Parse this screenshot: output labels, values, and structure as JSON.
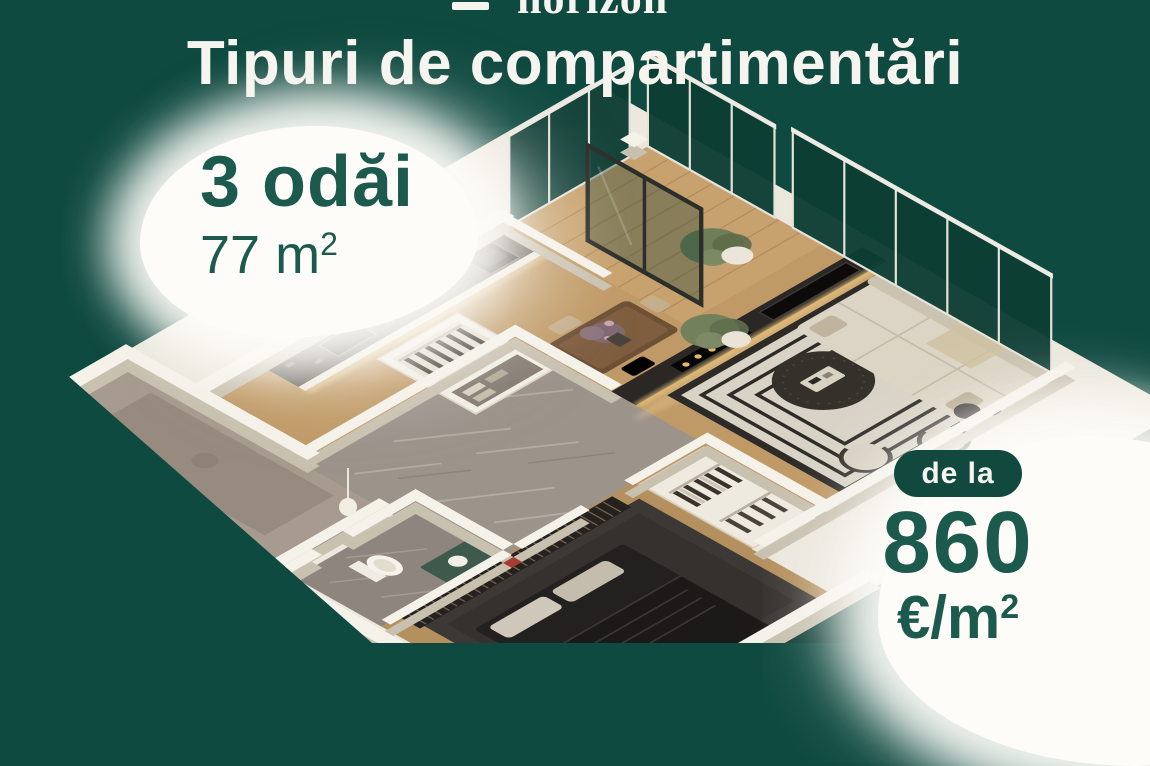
{
  "theme": {
    "bg_green": "#0f4a40",
    "text_green": "#1b5a4c",
    "pill_green": "#11493e",
    "cream": "#f6f4ee",
    "blob_white": "#fdfcf8",
    "glass_teal": "#0c3d34"
  },
  "header": {
    "logo": "horizon",
    "title": "Tipuri de compartimentări"
  },
  "unit_card": {
    "rooms": "3 odăi",
    "area_value": "77 m",
    "area_sup": "2"
  },
  "price_card": {
    "badge": "de la",
    "amount": "860",
    "unit": "€/m",
    "unit_sup": "2"
  },
  "floor_plan": {
    "description": "3D isometric render of a 3-room apartment: kitchen with counter, dining table, living room with sofa and TV wall, glass balconies, hallway, bathroom, bedroom and wardrobes"
  }
}
